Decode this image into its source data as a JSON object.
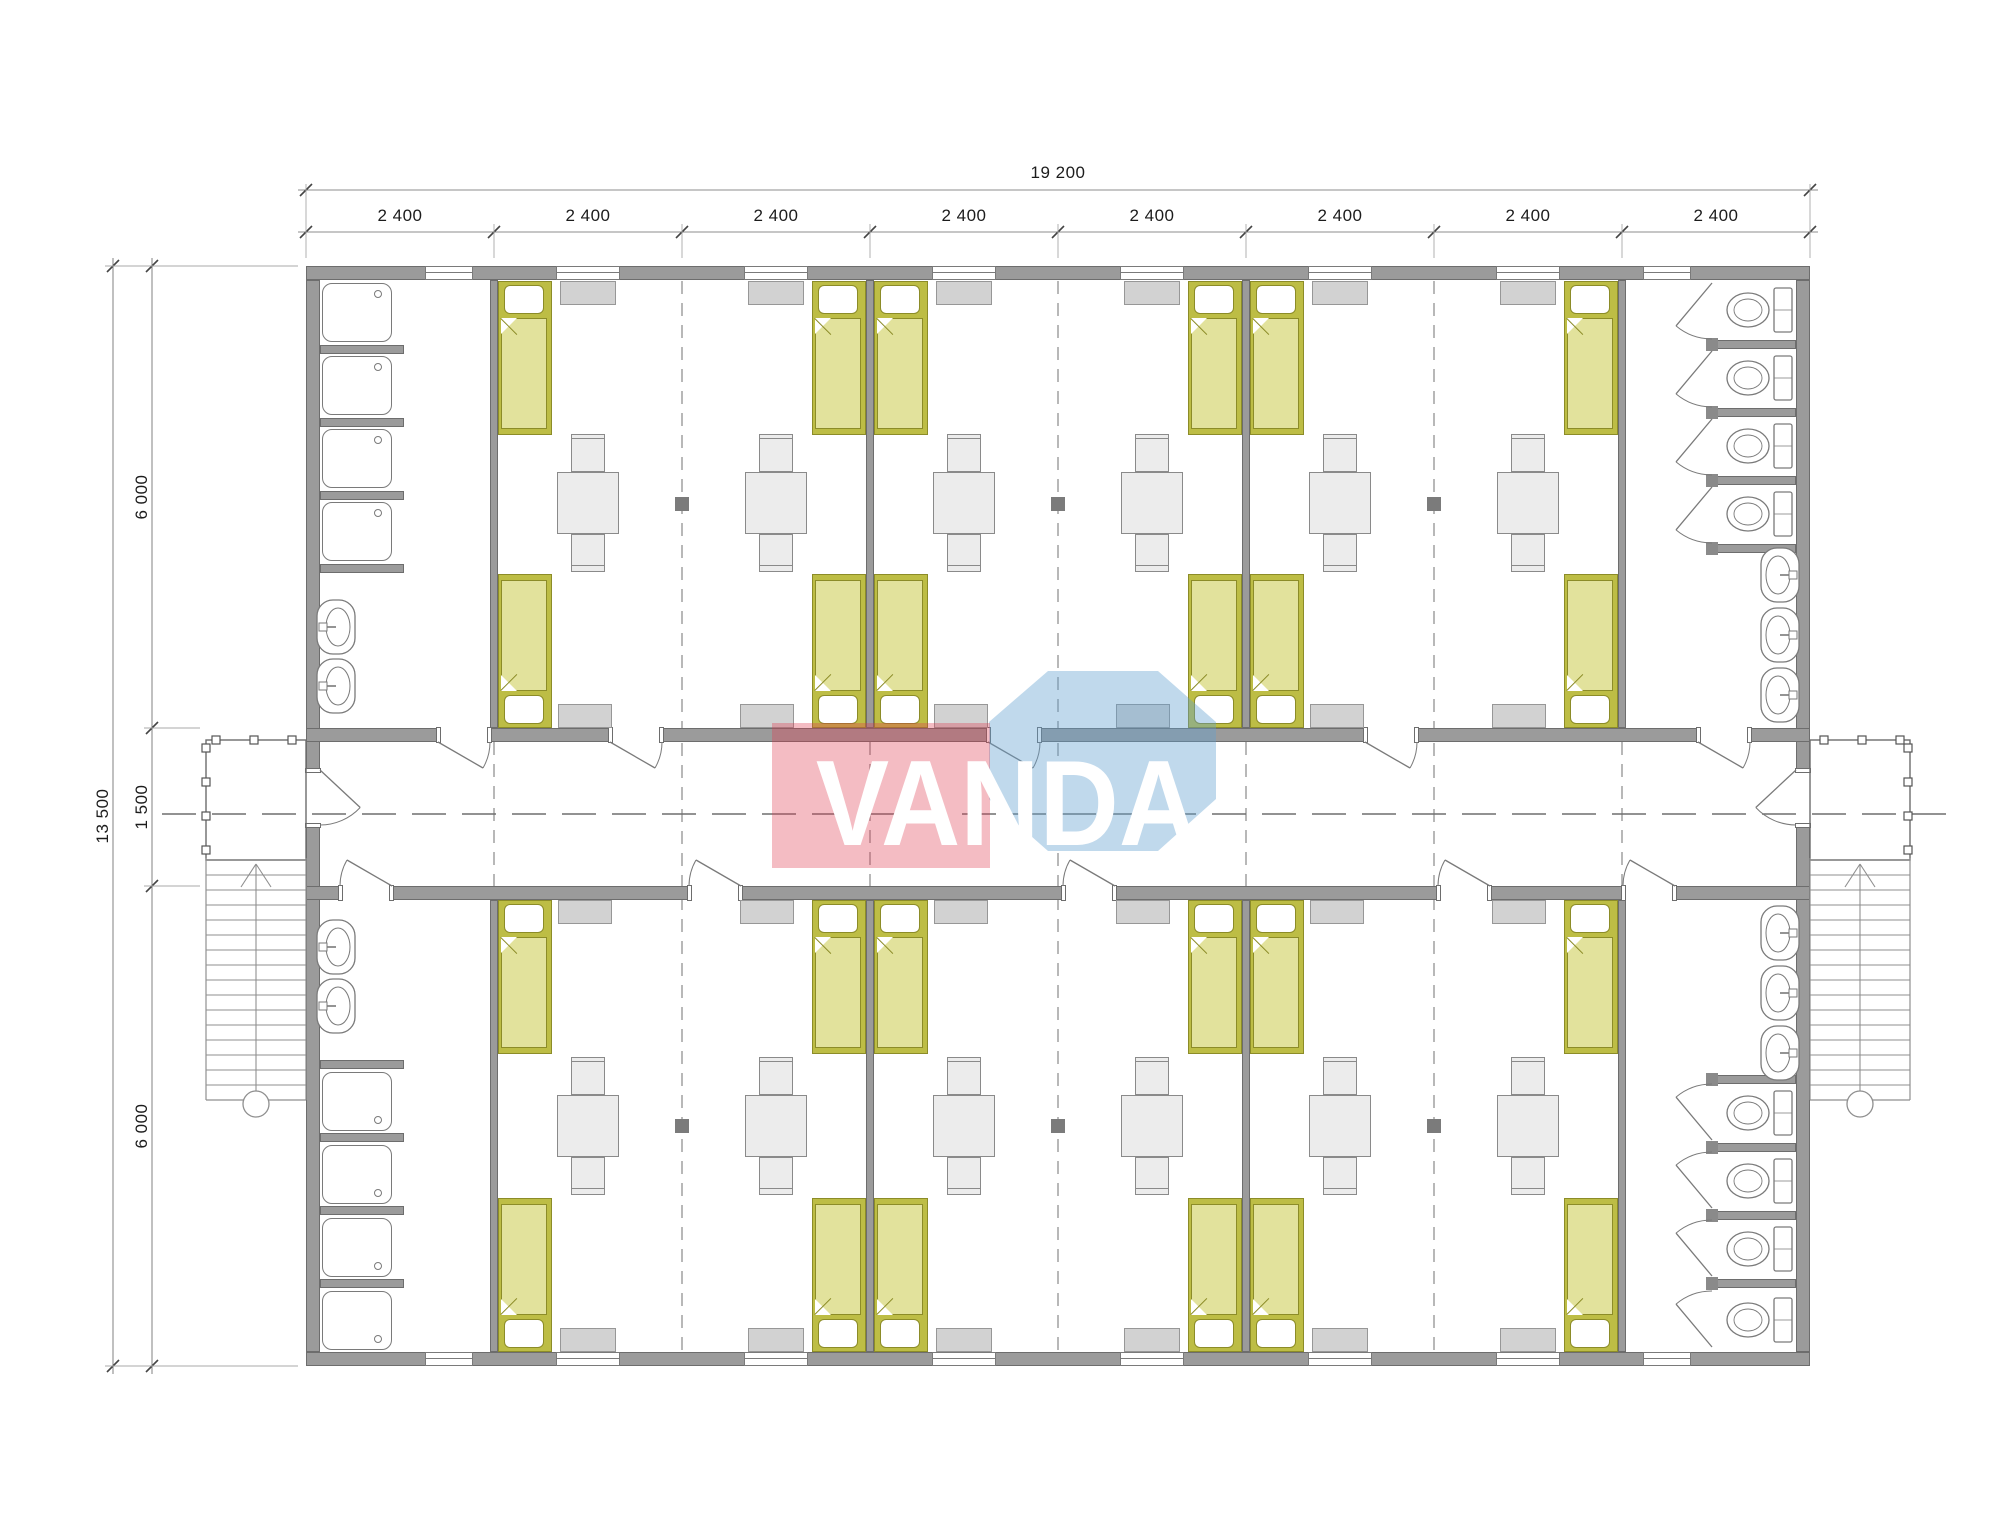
{
  "dimensions": {
    "total_width": "19 200",
    "modules": [
      "2 400",
      "2 400",
      "2 400",
      "2 400",
      "2 400",
      "2 400",
      "2 400",
      "2 400"
    ],
    "total_height": "13 500",
    "height_segments": [
      "6 000",
      "1 500",
      "6 000"
    ]
  },
  "watermark": {
    "text": "VANDA"
  },
  "summary": {
    "bedrooms": 6,
    "washrooms": 4,
    "beds": 24,
    "tables": 12,
    "chairs": 24,
    "showers": 8,
    "toilets": 8,
    "washbasins": 10,
    "staircases": 2,
    "entrances": 2
  },
  "colors": {
    "wall": "#9b9b9b",
    "wall_border": "#6d6d6d",
    "line": "#7a7a7a",
    "stair_line": "#8f8f8f",
    "dash": "#a0a0a0",
    "axis_dash": "#6f6f6f",
    "dim_line": "#8c8c8c",
    "dim_tick": "#444444",
    "dim_ext": "#aaaaaa",
    "dim_text": "#1c1c1c",
    "bed_frame_border": "#8c8c28",
    "bed_frame_fill": "#bdbd45",
    "bed_blanket": "#e2e29c",
    "pillow": "#ffffff",
    "furniture_fill": "#ececec",
    "furniture_border": "#8a8a8a",
    "radiator_fill": "#d2d2d2",
    "radiator_border": "#979797",
    "post": "#7b7b7b",
    "wm_pink": "rgba(224,58,80,0.34)",
    "wm_blue": "rgba(97,160,208,0.40)",
    "wm_text_color": "#ffffff"
  }
}
